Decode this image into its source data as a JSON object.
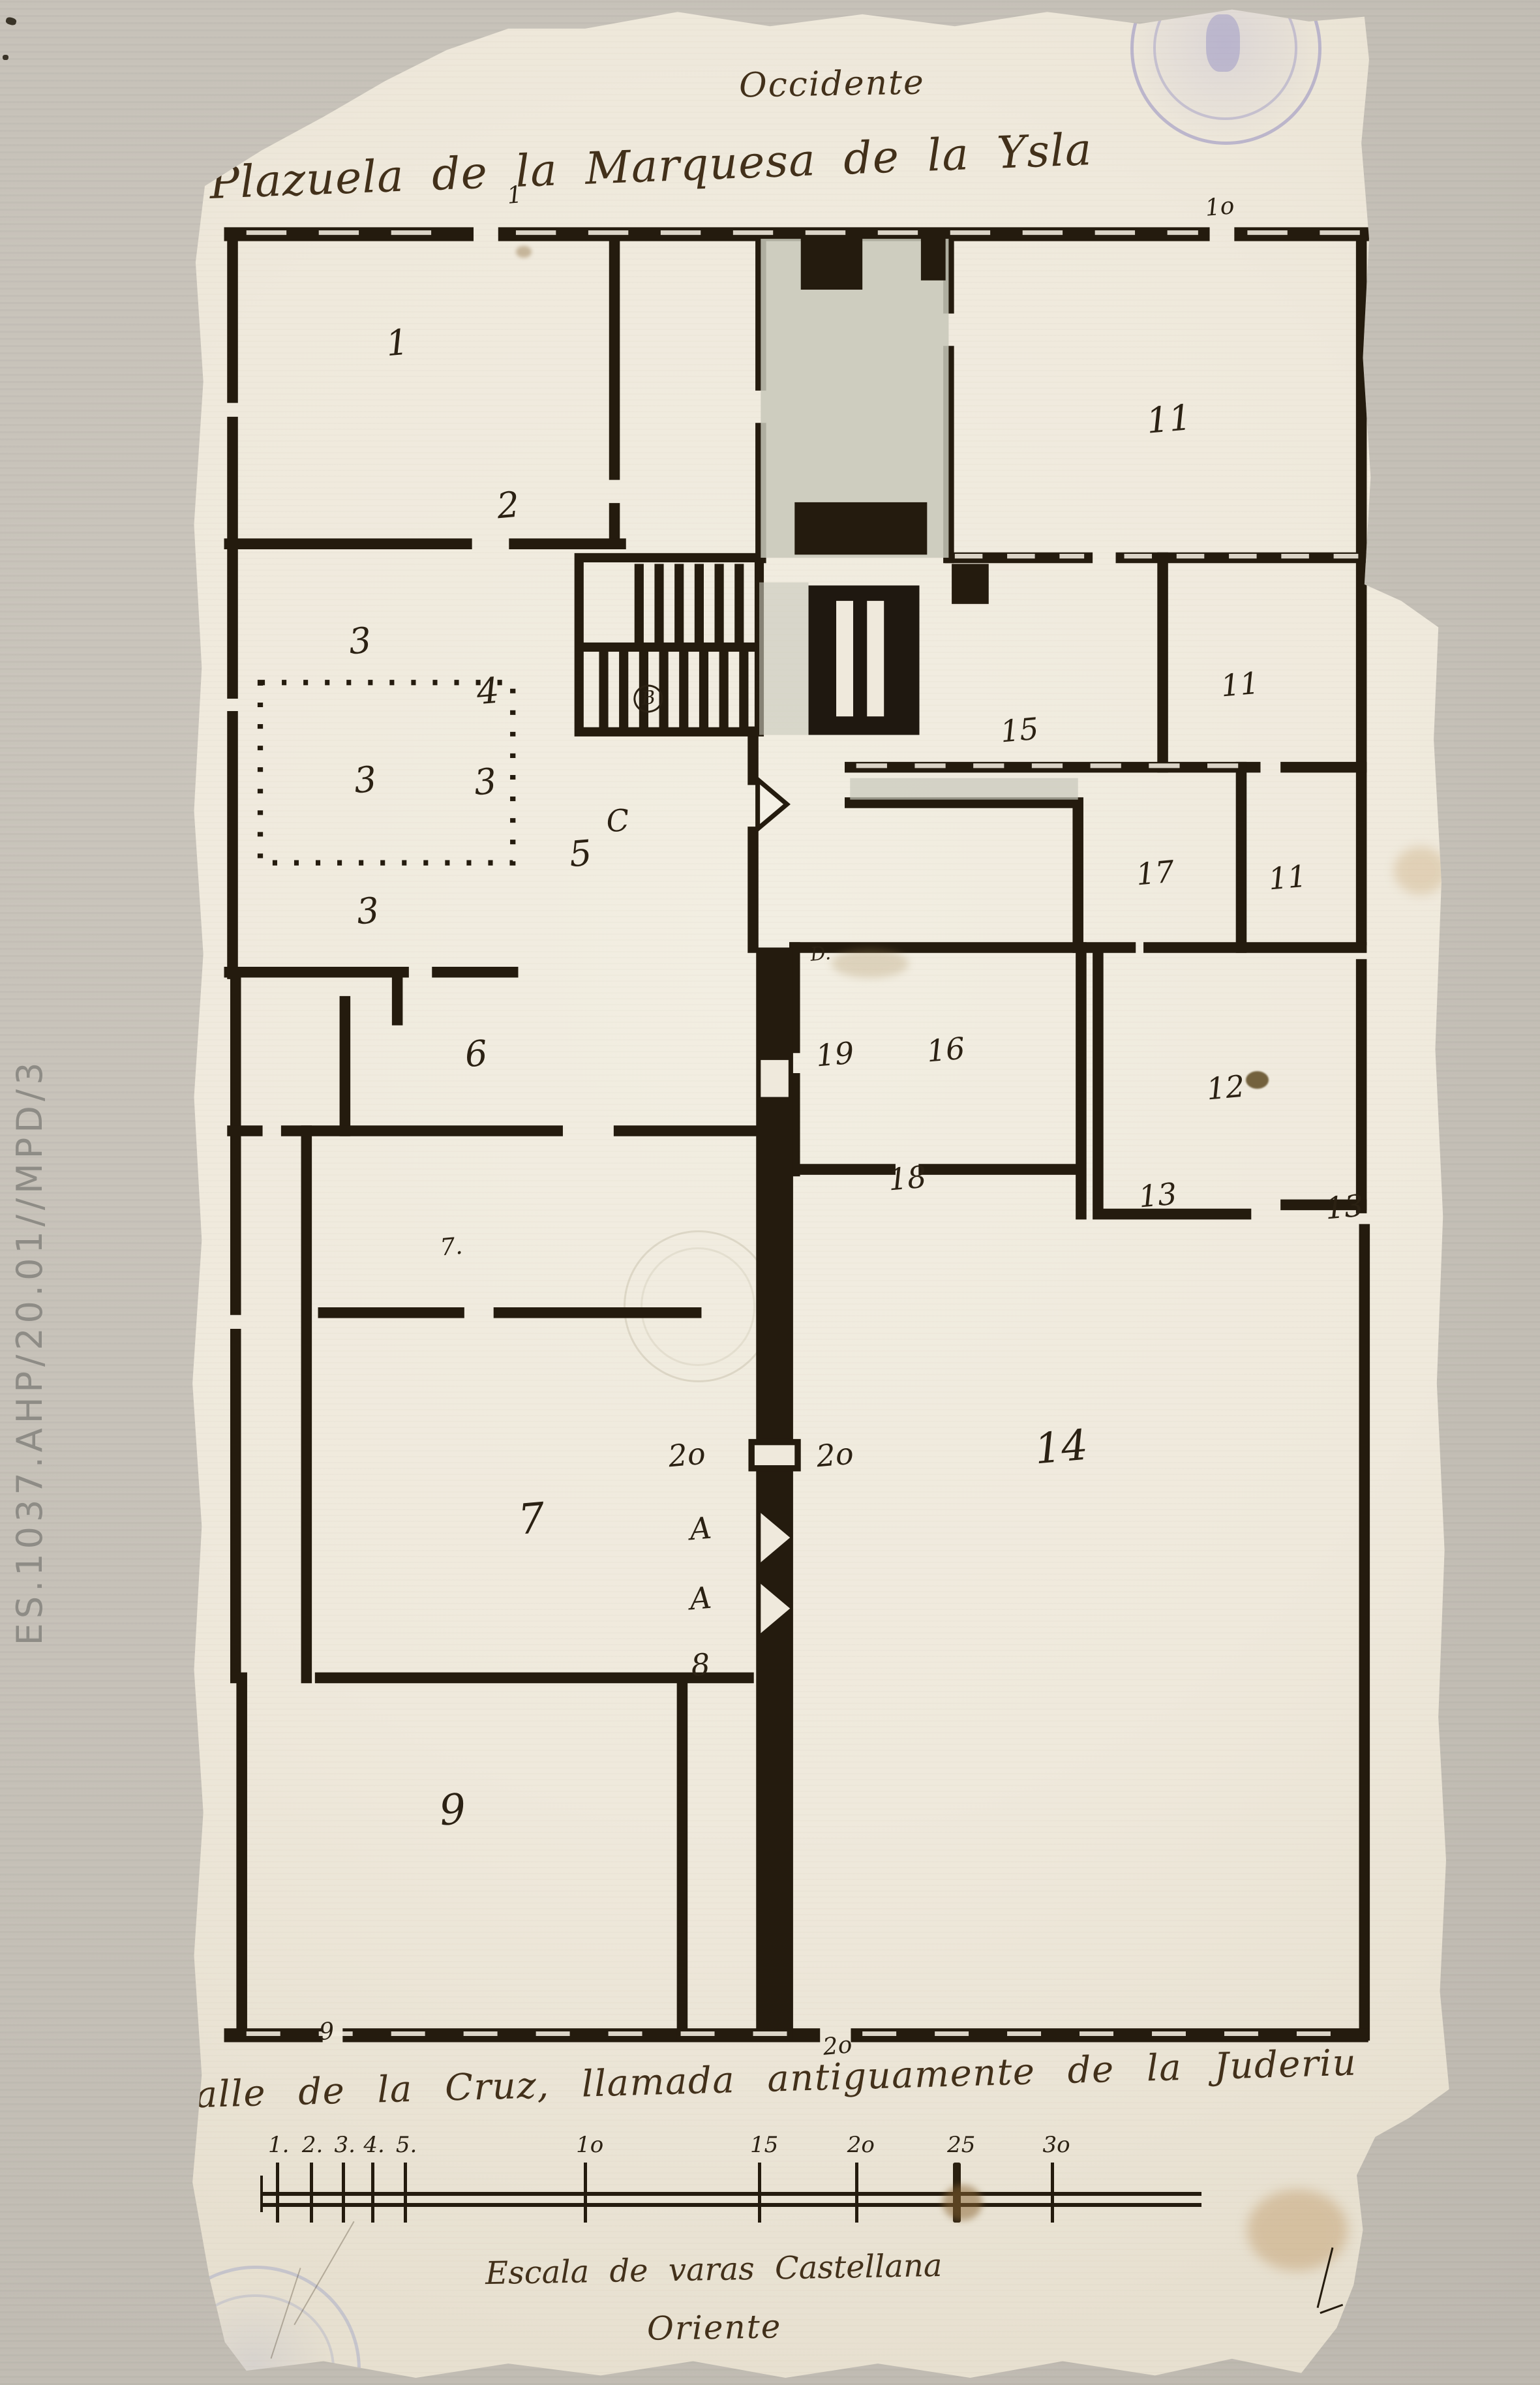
{
  "archive": {
    "reference": "ES.1037.AHP/20.01//MPD/3"
  },
  "titles": {
    "top_orientation": "Occidente",
    "top_street": "Plazuela de la Marquesa de la Ysla",
    "bottom_street": "Calle de la Cruz, llamada antiguamente de la Juderiu",
    "scale_caption": "Escala de varas Castellana",
    "bottom_orientation": "Oriente"
  },
  "plan_labels": [
    {
      "text": "1",
      "x": 25.8,
      "y": 14.4,
      "size": "lg"
    },
    {
      "text": "1",
      "x": 33.4,
      "y": 8.2,
      "size": "sm"
    },
    {
      "text": "1o",
      "x": 79.2,
      "y": 8.7,
      "size": "sm"
    },
    {
      "text": "11",
      "x": 75.9,
      "y": 17.6,
      "size": "lg"
    },
    {
      "text": "2",
      "x": 33.0,
      "y": 21.2,
      "size": "lg"
    },
    {
      "text": "3",
      "x": 23.4,
      "y": 26.9,
      "size": "lg"
    },
    {
      "text": "4",
      "x": 31.7,
      "y": 29.0,
      "size": "lg"
    },
    {
      "text": "B",
      "x": 42.1,
      "y": 29.3,
      "size": "xs",
      "circled": true
    },
    {
      "text": "11",
      "x": 80.5,
      "y": 28.7,
      "size": "md"
    },
    {
      "text": "15",
      "x": 66.2,
      "y": 30.6,
      "size": "md"
    },
    {
      "text": "3",
      "x": 23.7,
      "y": 32.7,
      "size": "lg"
    },
    {
      "text": "3",
      "x": 31.5,
      "y": 32.8,
      "size": "lg"
    },
    {
      "text": "C",
      "x": 40.1,
      "y": 34.4,
      "size": "md"
    },
    {
      "text": "5",
      "x": 37.7,
      "y": 35.8,
      "size": "lg"
    },
    {
      "text": "17",
      "x": 75.0,
      "y": 36.6,
      "size": "md"
    },
    {
      "text": "11",
      "x": 83.6,
      "y": 36.8,
      "size": "md"
    },
    {
      "text": "3",
      "x": 23.9,
      "y": 38.2,
      "size": "lg"
    },
    {
      "text": "D.",
      "x": 53.3,
      "y": 40.0,
      "size": "xs"
    },
    {
      "text": "19",
      "x": 54.2,
      "y": 44.2,
      "size": "md"
    },
    {
      "text": "16",
      "x": 61.4,
      "y": 44.0,
      "size": "md"
    },
    {
      "text": "6",
      "x": 30.9,
      "y": 44.2,
      "size": "lg"
    },
    {
      "text": "12",
      "x": 79.6,
      "y": 45.6,
      "size": "md"
    },
    {
      "text": "18",
      "x": 58.9,
      "y": 49.4,
      "size": "md"
    },
    {
      "text": "13",
      "x": 75.2,
      "y": 50.1,
      "size": "md"
    },
    {
      "text": "13",
      "x": 87.3,
      "y": 50.6,
      "size": "md"
    },
    {
      "text": "7.",
      "x": 29.3,
      "y": 52.3,
      "size": "sm"
    },
    {
      "text": "14",
      "x": 68.9,
      "y": 60.7,
      "size": "xl"
    },
    {
      "text": "2o",
      "x": 44.6,
      "y": 61.0,
      "size": "md"
    },
    {
      "text": "2o",
      "x": 54.2,
      "y": 61.0,
      "size": "md"
    },
    {
      "text": "7",
      "x": 34.5,
      "y": 63.7,
      "size": "xl"
    },
    {
      "text": "A",
      "x": 45.5,
      "y": 64.1,
      "size": "md"
    },
    {
      "text": "A",
      "x": 45.5,
      "y": 67.0,
      "size": "md"
    },
    {
      "text": "8",
      "x": 45.5,
      "y": 69.8,
      "size": "md"
    },
    {
      "text": "9",
      "x": 29.4,
      "y": 75.9,
      "size": "xl"
    },
    {
      "text": "9",
      "x": 21.2,
      "y": 85.2,
      "size": "sm"
    },
    {
      "text": "2o",
      "x": 54.4,
      "y": 85.8,
      "size": "sm"
    }
  ],
  "scale_bar": {
    "unit": "varas castellanas",
    "x_start": 17.0,
    "x_end": 78.0,
    "ticks": [
      {
        "label": "1.",
        "value": 1,
        "x": 18.0
      },
      {
        "label": "2.",
        "value": 2,
        "x": 20.2
      },
      {
        "label": "3.",
        "value": 3,
        "x": 22.3
      },
      {
        "label": "4.",
        "value": 4,
        "x": 24.2
      },
      {
        "label": "5.",
        "value": 5,
        "x": 26.3
      },
      {
        "label": "1o",
        "value": 10,
        "x": 38.0
      },
      {
        "label": "15",
        "value": 15,
        "x": 49.3
      },
      {
        "label": "2o",
        "value": 20,
        "x": 55.6
      },
      {
        "label": "25",
        "value": 25,
        "x": 62.1,
        "bold": true
      },
      {
        "label": "3o",
        "value": 30,
        "x": 68.3
      }
    ]
  }
}
